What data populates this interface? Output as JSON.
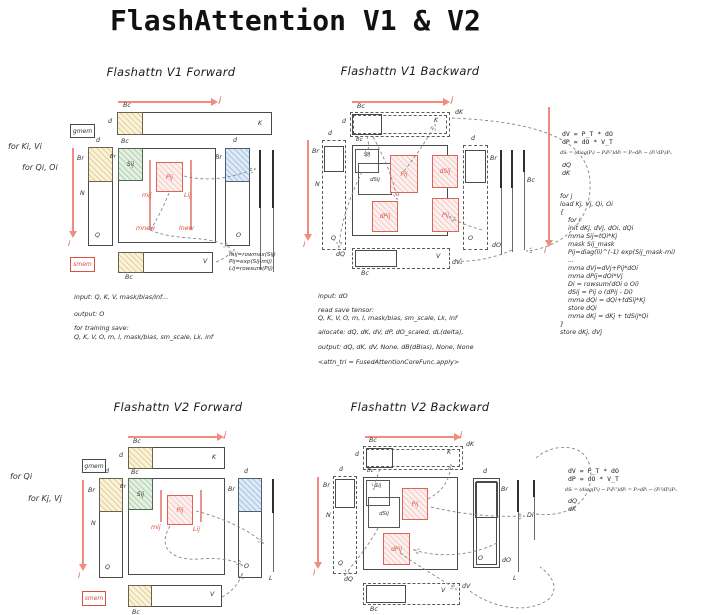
{
  "page_title": "FlashAttention V1 & V2",
  "colors": {
    "red_accent": "#d94f42",
    "arrow_red": "#f08c80",
    "tile_yellow": "#faf3d9",
    "tile_green": "#e4f1e2",
    "tile_blue": "#ddeaf8",
    "red_block_fill": "#fdf1ef",
    "ink": "#333333"
  },
  "labels": {
    "br": "Br",
    "bc": "Bc",
    "d": "d",
    "n": "N",
    "i": "i",
    "j": "j",
    "K": "K",
    "Q": "Q",
    "V": "V",
    "O": "O",
    "L": "L",
    "dK": "dK",
    "dQ": "dQ",
    "dV": "dV",
    "dO": "dO",
    "Di": "Di",
    "Sij": "Sij",
    "Pij": "Pij",
    "dSij": "dSij",
    "dPij": "dPij",
    "gmem": "gmem",
    "smem": "smem"
  },
  "v1f": {
    "title": "Flashattn V1 Forward",
    "loop1": "for Ki, Vi",
    "loop2": "for Qi, Oi",
    "mij": "mij",
    "Lij": "Lij",
    "mnew": "mnew",
    "lnew": "lnew",
    "formulas": [
      "mij=rowmax(Sij)",
      "Pij=exp(Sij-mij)",
      "Lij=rowsum(Pij)"
    ],
    "notes": [
      "input: Q, K, V, mask/bias/inf...",
      "output: O",
      "for training save:",
      "Q, K, V, O, m, l, mask/bias, sm_scale, Lk, inf"
    ]
  },
  "v1b": {
    "title": "Flashattn V1 Backward",
    "notes": [
      "input: dO",
      "read save tensor:",
      "Q, K, V, O, m, l, mask/bias, sm_scale, Lk, inf",
      "allocate: dQ, dK, dV, dP, dO_scaled, dL(delta),",
      "output: dQ, dK, dV, None, dB(dBias), None, None",
      "<attn_tri = FusedAttentionCoreFunc.apply>"
    ]
  },
  "side1": {
    "line1": "dV = P_T * dO",
    "line2": "dP = dO * V_T",
    "formula": "dSᵢ = (diag(Pᵢ) − PᵢPᵢᵀ)dPᵢ = Pᵢ∘dPᵢ − (PᵢᵀdPᵢ)Pᵢ.",
    "g1": "dQ",
    "g2": "dK",
    "code": [
      "for j",
      "load Kj, Vj, Qi, Oi",
      "{",
      "    for i",
      "    init dKj, dVj, dOi, dQi",
      "    mma Sij=tQi*Kj",
      "    mask Sij_mask",
      "    Pij=diag(li)^(-1) exp(Sij_mask-mi)",
      "    ...",
      "    mma dVj=dVj+Pij*dOi",
      "    mma dPij=dOi*Vj",
      "    Di = rowsum(dOi o Oi)",
      "    dSij = Pij o (dPij - Di)",
      "    mma dQi = dQi+tdSij*Kj",
      "    store dQi",
      "    mma dKj = dKj + tdSij*Qi",
      "}",
      "store dKj, dVj"
    ]
  },
  "v2f": {
    "title": "Flashattn V2 Forward",
    "loop1": "for Qi",
    "loop2": "for Kj, Vj",
    "mij": "mij",
    "Lij": "Lij"
  },
  "v2b": {
    "title": "Flashattn V2 Backward"
  },
  "side2": {
    "line1": "dV = P_T * dO",
    "line2": "dP = dO * V_T",
    "formula": "dSᵢ = (diag(Pᵢ) − PᵢPᵢᵀ)dPᵢ = Pᵢ∘dPᵢ − (PᵢᵀdPᵢ)Pᵢ.",
    "g1": "dQ",
    "g2": "dK"
  }
}
